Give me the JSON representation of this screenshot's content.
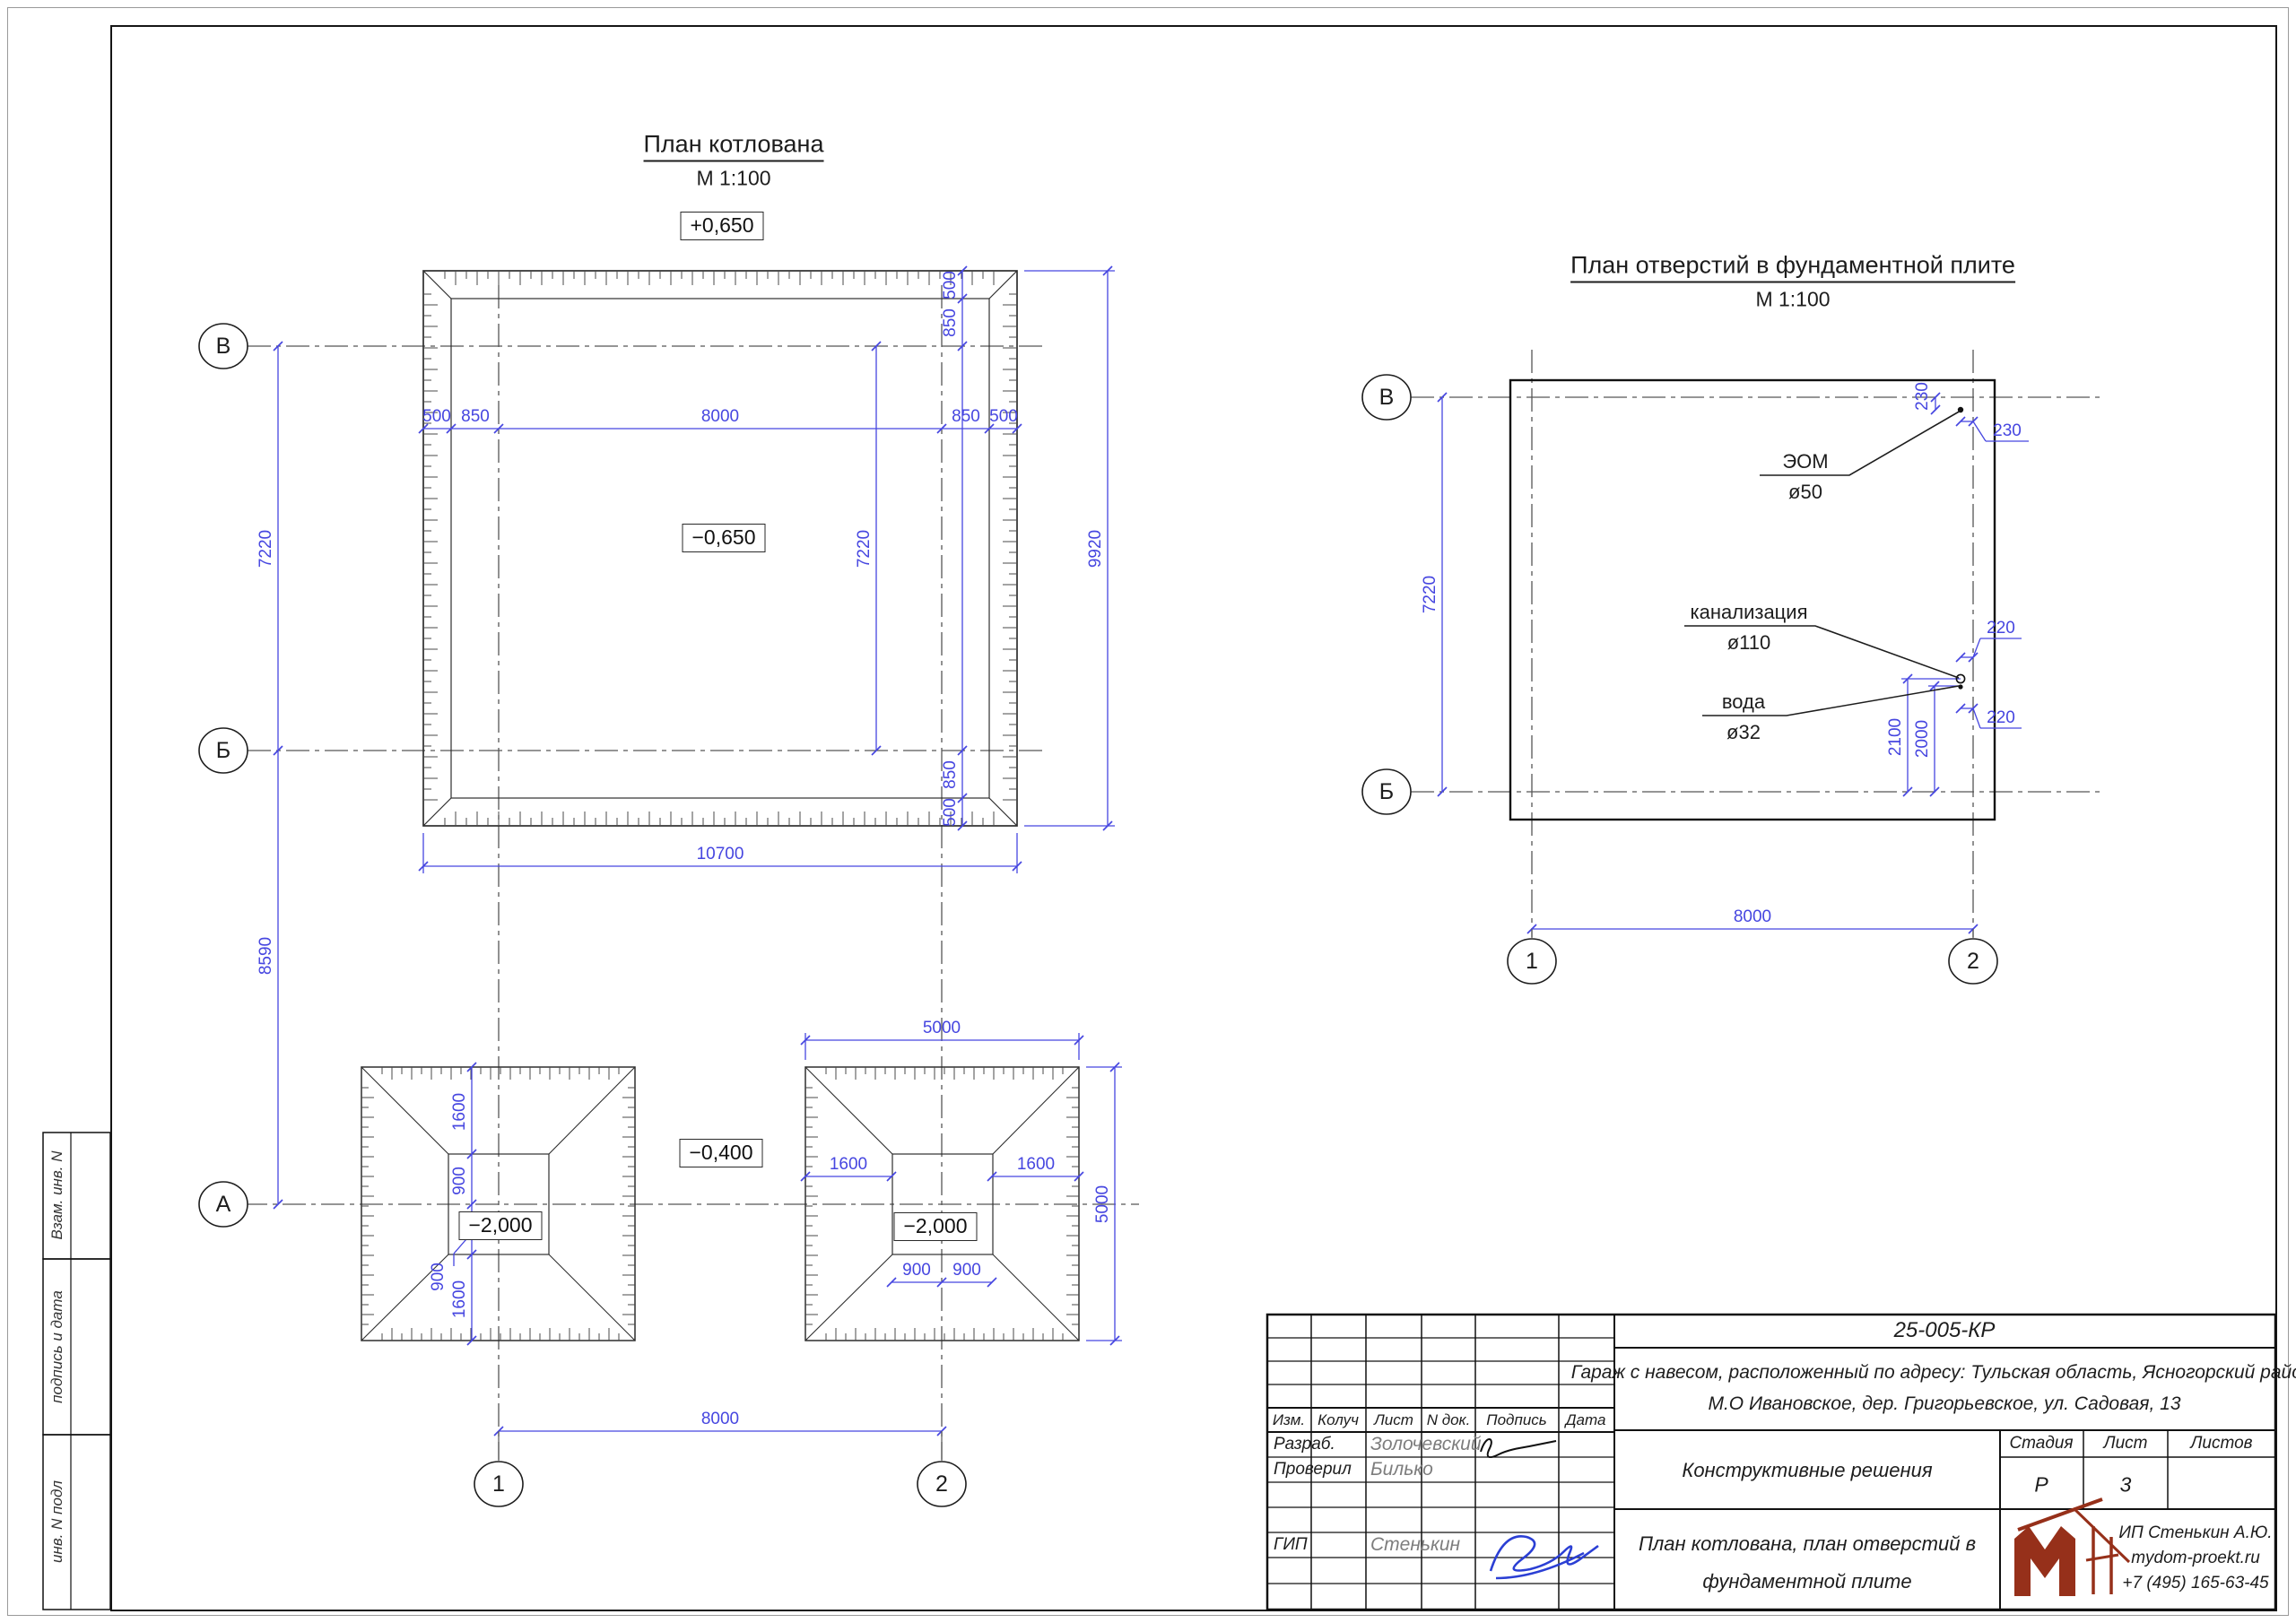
{
  "plan1": {
    "title": "План котлована",
    "scale": "М 1:100",
    "elevation_top": "+0,650",
    "elevation_inside": "−0,650",
    "top_chain": [
      "500",
      "850",
      "8000",
      "850",
      "500"
    ],
    "right_chain": [
      "500",
      "850",
      "850",
      "500"
    ],
    "dim_7220_inner": "7220",
    "total_width": "10700",
    "total_height": "9920",
    "left_dim_vb": "7220",
    "left_dim_ba": "8590",
    "axes": {
      "v": "В",
      "b": "Б",
      "a": "А",
      "c1": "1",
      "c2": "2"
    }
  },
  "footings": {
    "elevation_between": "−0,400",
    "elevation_pit": "−2,000",
    "left_chain": [
      "1600",
      "900",
      "900",
      "1600"
    ],
    "right_top": "5000",
    "right_side": "5000",
    "dim_1600_left": "1600",
    "dim_1600_right": "1600",
    "bottom_dims": [
      "900",
      "900"
    ],
    "axes_dim": "8000"
  },
  "plan2": {
    "title": "План отверстий в фундаментной плите",
    "scale": "М 1:100",
    "dim_left": "7220",
    "dim_bottom": "8000",
    "callout_eom": {
      "name": "ЭОМ",
      "dia": "ø50",
      "dim_v": "230",
      "dim_h": "230"
    },
    "callout_sewer": {
      "name": "канализация",
      "dia": "ø110",
      "dim_h": "220",
      "dim_v": "2100"
    },
    "callout_water": {
      "name": "вода",
      "dia": "ø32",
      "dim_h": "220",
      "dim_v": "2000"
    },
    "axes": {
      "v": "В",
      "b": "Б",
      "c1": "1",
      "c2": "2"
    }
  },
  "titleblock": {
    "doc_number": "25-005-КР",
    "object_line1": "Гараж с навесом, расположенный по адресу: Тульская область, Ясногорский район,",
    "object_line2": "М.О Ивановское, дер. Григорьевское, ул. Садовая, 13",
    "section_title": "Конструктивные решения",
    "sheet_name_line1": "План котлована, план отверстий в",
    "sheet_name_line2": "фундаментной плите",
    "header": [
      "Изм.",
      "Колуч",
      "Лист",
      "N док.",
      "Подпись",
      "Дата"
    ],
    "developer_role": "Разраб.",
    "developer_name": "Золочевский",
    "checker_role": "Проверил",
    "checker_name": "Билько",
    "gip_role": "ГИП",
    "gip_name": "Стенькин",
    "stage_label": "Стадия",
    "sheet_label": "Лист",
    "sheets_label": "Листов",
    "stage": "Р",
    "sheet": "3",
    "company": {
      "name": "ИП Стенькин А.Ю.",
      "site": "mydom-proekt.ru",
      "phone": "+7 (495) 165-63-45"
    }
  },
  "side_strips": [
    "Взам. инв. N",
    "подпись и дата",
    "инв. N подл"
  ],
  "colors": {
    "dim_blue": "#4646e0",
    "line_black": "#2e2e2e",
    "logo_brick": "#96301a",
    "sign_blue": "#2b3fd4"
  }
}
